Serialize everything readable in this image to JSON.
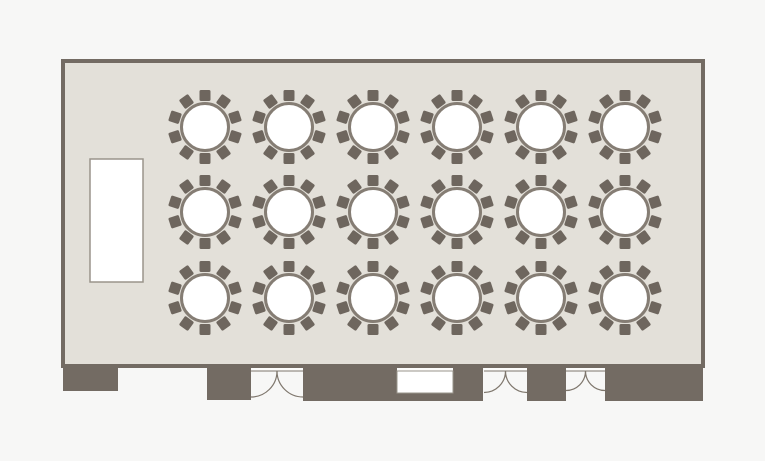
{
  "canvas": {
    "width": 765,
    "height": 461,
    "background": "#f7f7f6"
  },
  "colors": {
    "wall": "#736b63",
    "chair": "#6e665e",
    "table_ring": "#857d74",
    "table_fill": "#ffffff",
    "room_fill": "#e3e0d9",
    "door_line": "#7e766c",
    "opening_fill": "#fcfcfb",
    "stage_border": "#9a948b",
    "stage_fill": "#ffffff"
  },
  "room": {
    "x": 63,
    "y": 61,
    "width": 640,
    "height": 305,
    "border_width": 4
  },
  "stage": {
    "x": 90,
    "y": 159,
    "width": 53,
    "height": 123
  },
  "tables": {
    "count": 18,
    "grid": {
      "columns": 6,
      "rows": 3
    },
    "columns_x": [
      205,
      289,
      373,
      457,
      541,
      625
    ],
    "rows_y": [
      127,
      212,
      298
    ],
    "radius": 23.5,
    "ring_width": 3,
    "chairs_per_table": 10,
    "chair_size": 11,
    "chair_offset": 31.5
  },
  "bottom_walls": [
    {
      "x": 63,
      "y": 366,
      "width": 55,
      "height": 25
    },
    {
      "x": 207,
      "y": 366,
      "width": 44,
      "height": 34
    },
    {
      "x": 303,
      "y": 366,
      "width": 180,
      "height": 35
    },
    {
      "x": 527,
      "y": 366,
      "width": 39,
      "height": 35
    },
    {
      "x": 605,
      "y": 366,
      "width": 98,
      "height": 35
    }
  ],
  "doors": [
    {
      "type": "double",
      "x": 251,
      "y": 366,
      "width": 52
    },
    {
      "type": "double",
      "x": 484,
      "y": 366,
      "width": 43
    },
    {
      "type": "double",
      "x": 566,
      "y": 366,
      "width": 39
    }
  ],
  "service_window": {
    "x": 397,
    "y": 371,
    "width": 56,
    "height": 22
  }
}
